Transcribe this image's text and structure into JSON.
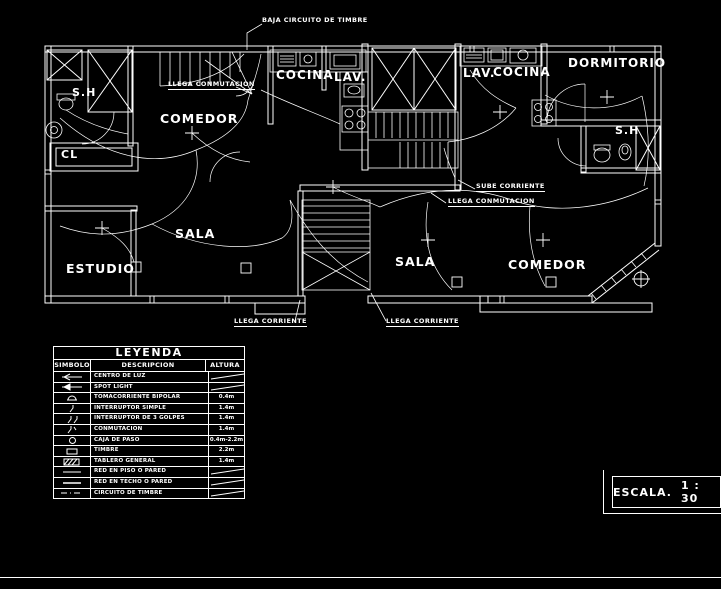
{
  "annotations": {
    "baja_circuito": "BAJA CIRCUITO DE TIMBRE",
    "llega_conmutacion_left": "LLEGA CONMUTACION",
    "sube_corriente": "SUBE CORRIENTE",
    "llega_conmutacion_right": "LLEGA CONMUTACION",
    "llega_corriente_left": "LLEGA CORRIENTE",
    "llega_corriente_right": "LLEGA CORRIENTE"
  },
  "rooms": {
    "sh_left": "S.H",
    "cl": "CL",
    "comedor_left": "COMEDOR",
    "cocina_left": "COCINA",
    "lav_left": "LAV.",
    "sala_left": "SALA",
    "estudio": "ESTUDIO",
    "lav_right": "LAV.",
    "cocina_right": "COCINA",
    "dormitorio": "DORMITORIO",
    "sh_right": "S.H",
    "sala_right": "SALA",
    "comedor_right": "COMEDOR"
  },
  "legend": {
    "title": "LEYENDA",
    "columns": {
      "simbolo": "SIMBOLO",
      "descripcion": "DESCRIPCION",
      "altura": "ALTURA"
    },
    "rows": [
      {
        "symbol": "centro-de-luz-symbol",
        "desc": "CENTRO DE LUZ",
        "altura": ""
      },
      {
        "symbol": "spot-light-symbol",
        "desc": "SPOT LIGHT",
        "altura": ""
      },
      {
        "symbol": "tomacorriente-bipolar-symbol",
        "desc": "TOMACORRIENTE BIPOLAR",
        "altura": "0.4m"
      },
      {
        "symbol": "interruptor-simple-symbol",
        "desc": "INTERRUPTOR SIMPLE",
        "altura": "1.4m"
      },
      {
        "symbol": "interruptor-3-golpes-symbol",
        "desc": "INTERRUPTOR DE 3 GOLPES",
        "altura": "1.4m"
      },
      {
        "symbol": "conmutacion-symbol",
        "desc": "CONMUTACION",
        "altura": "1.4m"
      },
      {
        "symbol": "caja-de-paso-symbol",
        "desc": "CAJA DE PASO",
        "altura": "0.4m-2.2m"
      },
      {
        "symbol": "timbre-symbol",
        "desc": "TIMBRE",
        "altura": "2.2m"
      },
      {
        "symbol": "tablero-general-symbol",
        "desc": "TABLERO GENERAL",
        "altura": "1.4m"
      },
      {
        "symbol": "red-en-piso-o-pared-symbol",
        "desc": "RED EN PISO O PARED",
        "altura": ""
      },
      {
        "symbol": "red-en-techo-o-pared-symbol",
        "desc": "RED EN TECHO O PARED",
        "altura": ""
      },
      {
        "symbol": "circuito-de-timbre-symbol",
        "desc": "CIRCUITO DE TIMBRE",
        "altura": ""
      }
    ]
  },
  "scale": {
    "label": "ESCALA.",
    "value": "1 : 30"
  },
  "colors": {
    "background": "#000000",
    "line": "#ffffff"
  }
}
